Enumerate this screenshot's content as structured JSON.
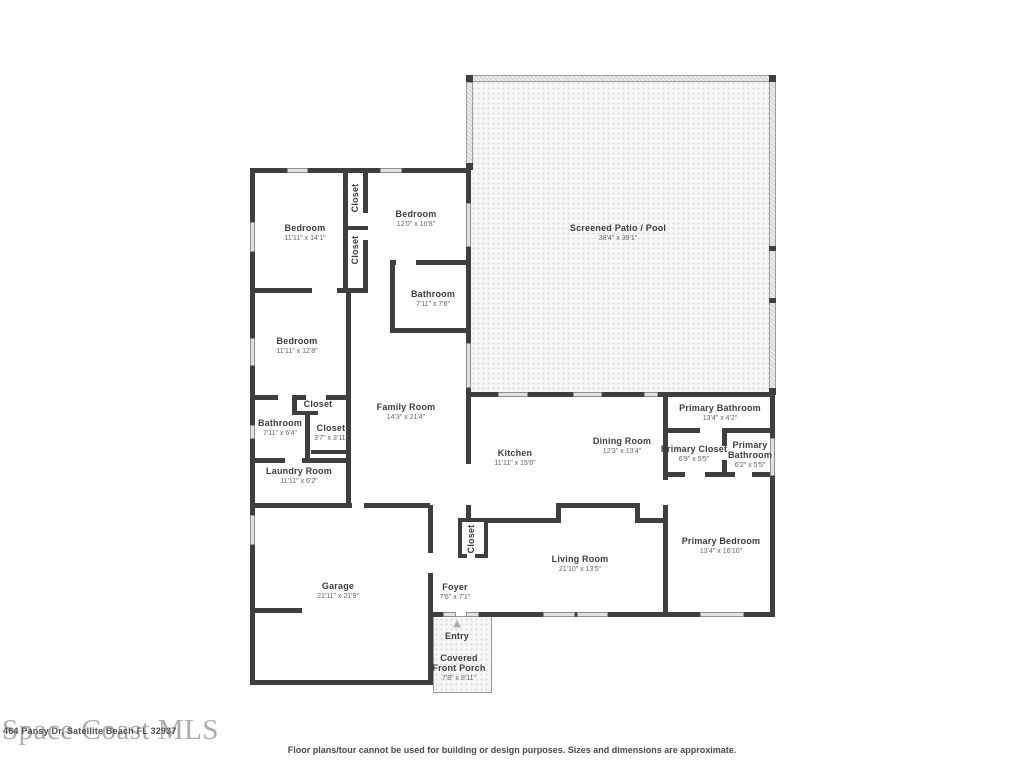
{
  "watermark": "Space Coast MLS",
  "address": "464 Pansy Dr, Satellite Beach FL 32937",
  "disclaimer": "Floor plans/tour cannot be used for building or design purposes. Sizes and dimensions are approximate.",
  "entry": {
    "label": "Entry",
    "arrow": "▲"
  },
  "colors": {
    "wall": "#3f3f3f",
    "window_fill": "#e2e2e2",
    "screen_wall": "#ededed",
    "patio_dots": "#d9d9d9",
    "room_name_text": "#3d3d3d",
    "dims_text": "#666666",
    "watermark_gray": "#8e8e8e"
  },
  "rooms": {
    "bedroom1": {
      "name": "Bedroom",
      "dims": "11'11\" x 14'1\""
    },
    "bedroom2": {
      "name": "Bedroom",
      "dims": "12'0\" x 10'8\""
    },
    "bathroom1": {
      "name": "Bathroom",
      "dims": "7'11\" x 7'6\""
    },
    "bedroom3": {
      "name": "Bedroom",
      "dims": "11'11\" x 12'8\""
    },
    "bathroom2": {
      "name": "Bathroom",
      "dims": "7'11\" x 6'4\""
    },
    "closet_top": {
      "name": "Closet"
    },
    "closet_mid": {
      "name": "Closet"
    },
    "closet_hall": {
      "name": "Closet"
    },
    "closet_small": {
      "name": "Closet",
      "dims": "3'7\" x 3'11\""
    },
    "closet_foyer": {
      "name": "Closet"
    },
    "laundry": {
      "name": "Laundry Room",
      "dims": "11'11\" x 6'2\""
    },
    "family": {
      "name": "Family Room",
      "dims": "14'3\" x 21'4\""
    },
    "kitchen": {
      "name": "Kitchen",
      "dims": "11'11\" x 15'6\""
    },
    "dining": {
      "name": "Dining Room",
      "dims": "12'3\" x 13'4\""
    },
    "patio": {
      "name": "Screened Patio / Pool",
      "dims": "38'4\" x 39'1\""
    },
    "primary_bath_1": {
      "name": "Primary Bathroom",
      "dims": "13'4\" x 4'2\""
    },
    "primary_closet": {
      "name": "Primary Closet",
      "dims": "6'9\" x 5'5\""
    },
    "primary_bath_2": {
      "name": "Primary Bathroom",
      "dims": "6'2\" x 5'5\""
    },
    "primary_bedroom": {
      "name": "Primary Bedroom",
      "dims": "13'4\" x 16'10\""
    },
    "living": {
      "name": "Living Room",
      "dims": "21'10\" x 13'5\""
    },
    "garage": {
      "name": "Garage",
      "dims": "21'11\" x 21'9\""
    },
    "foyer": {
      "name": "Foyer",
      "dims": "7'6\" x 7'1\""
    },
    "porch": {
      "name": "Covered Front Porch",
      "dims": "7'8\" x 8'11\""
    }
  }
}
